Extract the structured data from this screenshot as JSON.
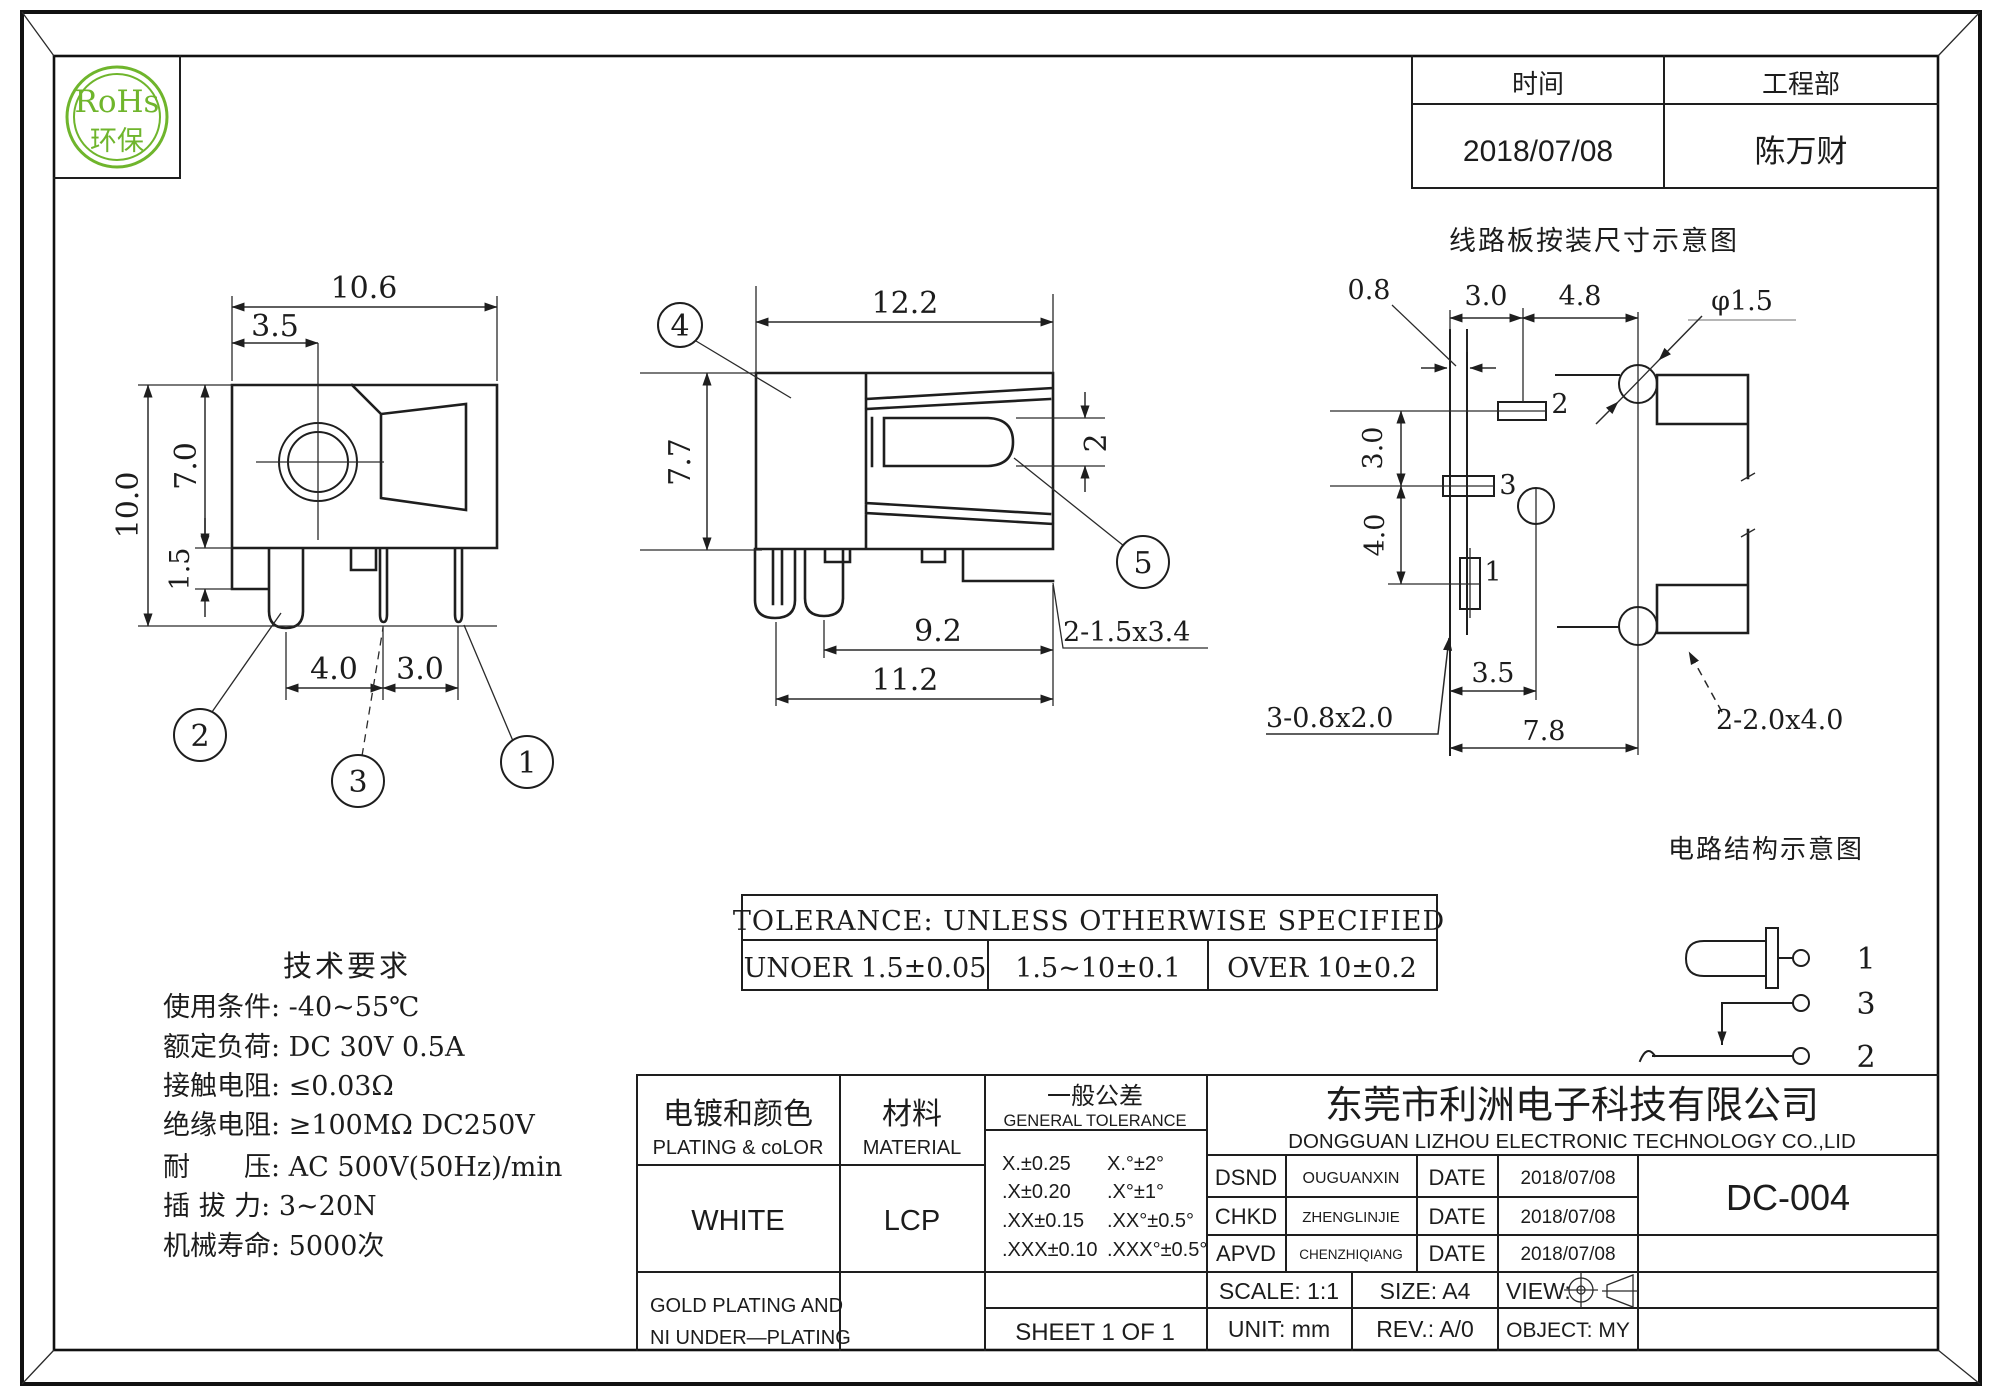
{
  "logo": {
    "name": "RoHs",
    "subtitle": "环保",
    "color": "#6fb52c"
  },
  "header": {
    "time_label": "时间",
    "dept_label": "工程部",
    "time_value": "2018/07/08",
    "dept_value": "陈万财"
  },
  "front_view": {
    "dim_width": "10.6",
    "dim_offset": "3.5",
    "dim_total_height": "10.0",
    "dim_body_height": "7.0",
    "dim_standoff": "1.5",
    "dim_pitch_a": "4.0",
    "dim_pitch_b": "3.0",
    "callout_1": "1",
    "callout_2": "2",
    "callout_3": "3"
  },
  "side_view": {
    "dim_width": "12.2",
    "dim_height": "7.7",
    "dim_pin": "2",
    "dim_len_a": "9.2",
    "dim_len_b": "11.2",
    "note_slot": "2-1.5x3.4",
    "callout_4": "4",
    "callout_5": "5"
  },
  "pcb_view": {
    "title": "线路板按装尺寸示意图",
    "dim_a": "0.8",
    "dim_b": "3.0",
    "dim_c": "4.8",
    "dim_hole": "φ1.5",
    "dim_d": "3.0",
    "dim_e": "4.0",
    "dim_f": "3.5",
    "dim_g": "7.8",
    "note_pads": "3-0.8x2.0",
    "note_slots": "2-2.0x4.0",
    "pad1": "1",
    "pad2": "2",
    "pad3": "3"
  },
  "circuit": {
    "title": "电路结构示意图",
    "terminal_1": "1",
    "terminal_3": "3",
    "terminal_2": "2"
  },
  "tolerance": {
    "title": "TOLERANCE: UNLESS OTHERWISE SPECIFIED",
    "under": "UNOER 1.5±0.05",
    "mid": "1.5~10±0.1",
    "over": "OVER 10±0.2"
  },
  "tech": {
    "title": "技术要求",
    "lines": [
      "使用条件: -40~55℃",
      "额定负荷: DC 30V 0.5A",
      "接触电阻: ≤0.03Ω",
      "绝缘电阻: ≥100MΩ DC250V",
      "耐　　压: AC 500V(50Hz)/min",
      "插 拔 力: 3~20N",
      "机械寿命: 5000次"
    ]
  },
  "title_block": {
    "plating": {
      "zh": "电镀和颜色",
      "en": "PLATING & coLOR",
      "value": "WHITE",
      "note1": "GOLD PLATING AND",
      "note2": "NI UNDER—PLATING"
    },
    "material": {
      "zh": "材料",
      "en": "MATERIAL",
      "value": "LCP"
    },
    "gentol": {
      "zh": "一般公差",
      "en": "GENERAL TOLERANCE",
      "r1a": "X.±0.25",
      "r1b": "X.°±2°",
      "r2a": ".X±0.20",
      "r2b": ".X°±1°",
      "r3a": ".XX±0.15",
      "r3b": ".XX°±0.5°",
      "r4a": ".XXX±0.10",
      "r4b": ".XXX°±0.5°",
      "sheet": "SHEET 1 OF 1"
    },
    "company": {
      "zh": "东莞市利洲电子科技有限公司",
      "en": "DONGGUAN LIZHOU ELECTRONIC TECHNOLOGY CO.,LID"
    },
    "approvals": {
      "r1_role": "DSND",
      "r1_name": "OUGUANXIN",
      "r1_datelabel": "DATE",
      "r1_date": "2018/07/08",
      "r2_role": "CHKD",
      "r2_name": "ZHENGLINJIE",
      "r2_datelabel": "DATE",
      "r2_date": "2018/07/08",
      "r3_role": "APVD",
      "r3_name": "CHENZHIQIANG",
      "r3_datelabel": "DATE",
      "r3_date": "2018/07/08"
    },
    "part_number": "DC-004",
    "info": {
      "scale": "SCALE:  1:1",
      "size": "SIZE:  A4",
      "view": "VIEW:",
      "unit": "UNIT:  mm",
      "rev": "REV.:  A/0",
      "object": "OBJECT:  MY"
    }
  }
}
